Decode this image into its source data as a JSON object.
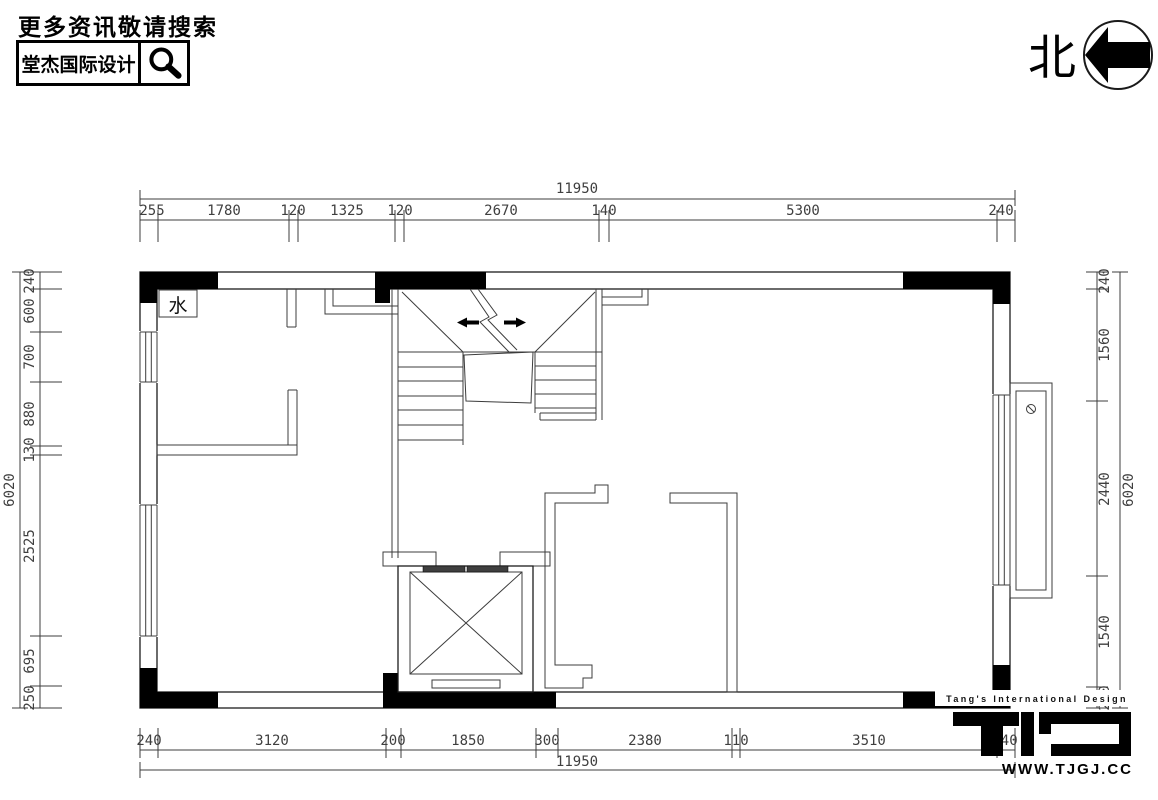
{
  "header": {
    "prompt": "更多资讯敬请搜索",
    "brand": "堂杰国际设计"
  },
  "compass": {
    "north_label": "北"
  },
  "plan": {
    "water_label": "水"
  },
  "dims": {
    "top": {
      "total": "11950",
      "segments": [
        "255",
        "1780",
        "120",
        "1325",
        "120",
        "2670",
        "140",
        "5300",
        "240"
      ]
    },
    "bottom": {
      "total": "11950",
      "segments": [
        "240",
        "3120",
        "200",
        "1850",
        "300",
        "2380",
        "110",
        "3510",
        "240"
      ]
    },
    "left": {
      "total": "6020",
      "segments": [
        "240",
        "600",
        "700",
        "880",
        "130",
        "2525",
        "695",
        "250"
      ]
    },
    "right": {
      "total": "6020",
      "segments": [
        "240",
        "1560",
        "2440",
        "1540",
        "240"
      ]
    }
  },
  "footer": {
    "tagline": "Tang's International Design",
    "website": "WWW.TJGJ.CC"
  },
  "colors": {
    "ink": "#000000",
    "line": "#3c3c3c",
    "paper": "#ffffff"
  }
}
